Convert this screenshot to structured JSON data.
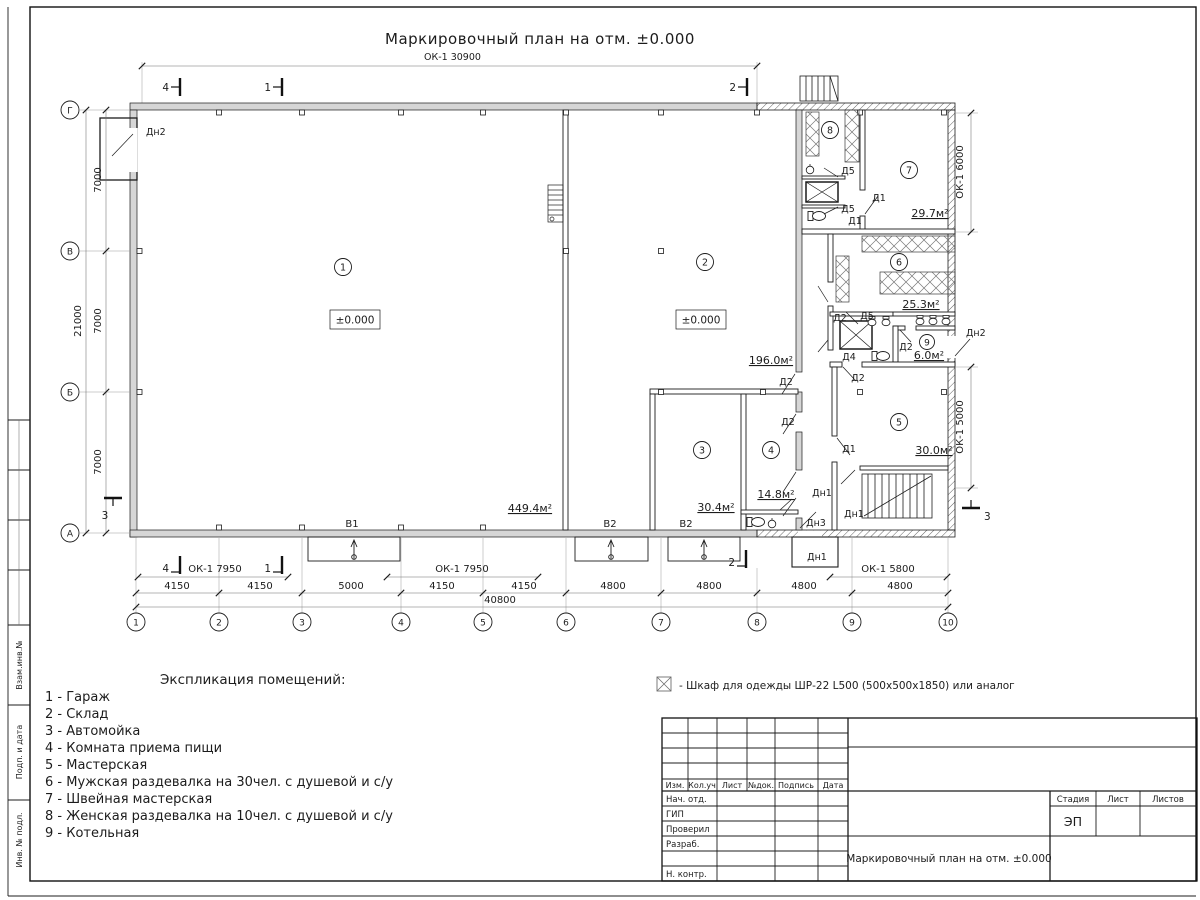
{
  "sheet": {
    "title": "Маркировочный план на отм. ±0.000",
    "note_text": "-  Шкаф для одежды ШР-22 L500 (500х500х1850) или аналог"
  },
  "axes": {
    "cols": [
      "1",
      "2",
      "3",
      "4",
      "5",
      "6",
      "7",
      "8",
      "9",
      "10"
    ],
    "rows": [
      "Г",
      "В",
      "Б",
      "А"
    ]
  },
  "dims": {
    "top_window": "ОК-1 30900",
    "bottom_windows": [
      "ОК-1 7950",
      "ОК-1 7950",
      "ОК-1 5800"
    ],
    "bottom_segments": [
      "4150",
      "4150",
      "5000",
      "4150",
      "4150",
      "4800",
      "4800",
      "4800",
      "4800"
    ],
    "bottom_total": "40800",
    "left_segments": [
      "7000",
      "7000",
      "7000"
    ],
    "left_total": "21000",
    "right_windows": [
      "ОК-1 6000",
      "ОК-1 5000"
    ]
  },
  "sections": {
    "s1": "1",
    "s2": "2",
    "s3": "3",
    "s4": "4"
  },
  "plan": {
    "room_numbers": [
      "1",
      "2",
      "3",
      "4",
      "5",
      "6",
      "7",
      "8",
      "9"
    ],
    "areas": [
      "449.4м²",
      "196.0м²",
      "30.4м²",
      "14.8м²",
      "30.0м²",
      "25.3м²",
      "29.7м²",
      "6.0м²"
    ],
    "levels": [
      "±0.000",
      "±0.000"
    ],
    "door_labels": [
      "Дн2",
      "Д5",
      "Д1",
      "Д5",
      "Д1",
      "Д2",
      "Д5",
      "Д2",
      "Дн2",
      "Д4",
      "Д2",
      "Д2",
      "Д2",
      "Д1",
      "Дн1",
      "Дн1",
      "Дн3",
      "Дн1"
    ],
    "gate_labels": [
      "В1",
      "В2",
      "В2"
    ]
  },
  "legend": {
    "heading": "Экспликация помещений:",
    "items": [
      "1 - Гараж",
      "2 - Склад",
      "3 - Автомойка",
      "4 - Комната приема пищи",
      "5 - Мастерская",
      "6 - Мужская раздевалка на 30чел. с душевой и с/у",
      "7 - Швейная мастерская",
      "8 - Женская раздевалка на 10чел. с душевой и с/у",
      "9 - Котельная"
    ]
  },
  "titleblock": {
    "rev_headers": [
      "Изм.",
      "Кол.уч",
      "Лист",
      "№док.",
      "Подпись",
      "Дата"
    ],
    "sig_labels": [
      "Нач. отд.",
      "ГИП",
      "Проверил",
      "Разраб.",
      "Н. контр."
    ],
    "stage_headers": [
      "Стадия",
      "Лист",
      "Листов"
    ],
    "stage_value": "ЭП",
    "doc_title": "Маркировочный план на отм. ±0.000"
  },
  "frame_strip": [
    "Взам.инв.№",
    "Подп. и дата",
    "Инв. № подл."
  ]
}
